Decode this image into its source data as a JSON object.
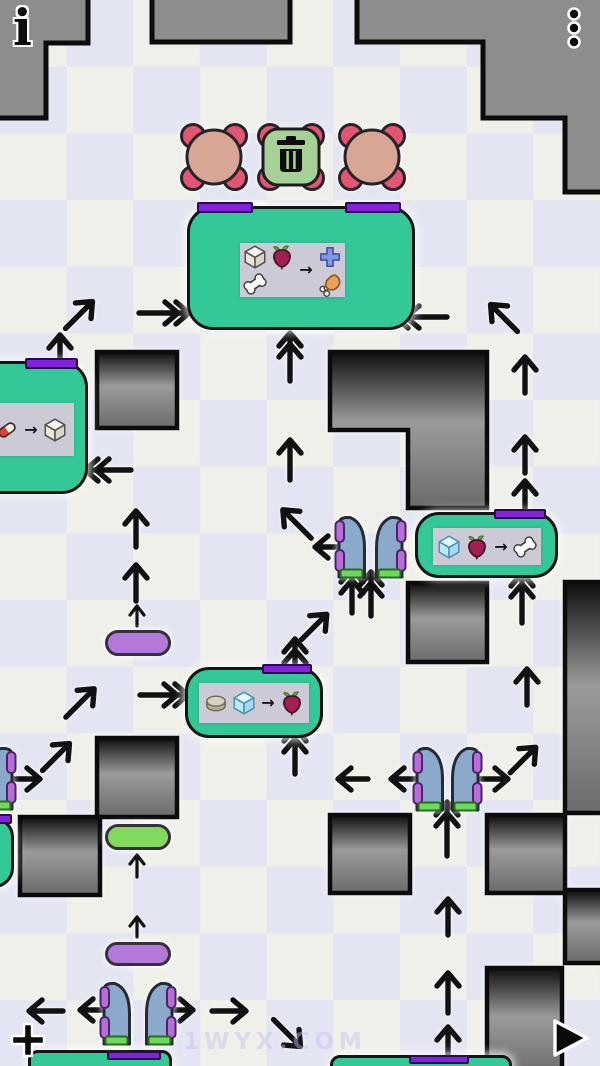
{
  "hud": {
    "info_glyph": "i",
    "watermark": "1WYX.COM"
  },
  "recipe_arrow": "→",
  "palette": {
    "checker_light": "#eff0e9",
    "checker_lavender": "#e3e5f2",
    "border_wall": "#8d8d8d",
    "machine_teal": "#34c797",
    "slot_purple": "#8520df",
    "foot_green": "#6cd95b",
    "gate_blue": "#8aa9cb",
    "gate_tab_purple": "#b46fd8",
    "spawner_pink": "#e45571",
    "spawner_tan": "#d7a695",
    "trash_green": "#a5d096",
    "pill_purple": "#b477da",
    "pill_green": "#82d95e"
  },
  "border_walls": [
    "M-10,-10 H88 V43 H46 V118 H-10 Z",
    "M152,-10 H290 V42 H152 Z",
    "M357,-10 H610 V192 H565 V118 H483 V42 H357 Z"
  ],
  "wall_blocks": [
    "M97,352 h80 v76 h-80 Z",
    "M330,352 H487 V508 H408 V430 H330 Z",
    "M408,583 h79 v79 h-79 Z",
    "M565,582 h50 v231 h-50 Z",
    "M330,815 h80 v78 h-80 Z",
    "M487,815 h78 v78 h-78 Z",
    "M565,890 h50 v73 h-50 Z",
    "M97,738 h80 v79 h-80 Z",
    "M20,817 h80 v78 h-80 Z",
    "M487,968 h75 v108 h-75 Z"
  ],
  "spawners": [
    {
      "x": 180,
      "y": 123,
      "kind": "creature"
    },
    {
      "x": 257,
      "y": 123,
      "kind": "trash"
    },
    {
      "x": 338,
      "y": 123,
      "kind": "creature"
    }
  ],
  "machines": [
    {
      "x": 187,
      "y": 206,
      "w": 228,
      "h": 124,
      "r": 26,
      "bars": [
        [
          197,
          202,
          56,
          11
        ],
        [
          345,
          202,
          56,
          11
        ]
      ],
      "panel": {
        "x": 240,
        "y": 243,
        "w": 105,
        "h": 54,
        "layout": "grid2"
      },
      "inputs": [
        "cube",
        "beet",
        "bone"
      ],
      "outputs": [
        "plus",
        "drumstick"
      ]
    },
    {
      "x": -52,
      "y": 361,
      "w": 140,
      "h": 133,
      "r": 26,
      "bars": [
        [
          25,
          358,
          53,
          11
        ]
      ],
      "panel": {
        "x": -12,
        "y": 403,
        "w": 86,
        "h": 53,
        "layout": "row"
      },
      "inputs": [
        "pill"
      ],
      "outputs": [
        "cube"
      ]
    },
    {
      "x": 415,
      "y": 512,
      "w": 143,
      "h": 66,
      "r": 24,
      "bars": [
        [
          494,
          509,
          52,
          10
        ]
      ],
      "panel": {
        "x": 433,
        "y": 528,
        "w": 108,
        "h": 37,
        "layout": "row"
      },
      "inputs": [
        "ice",
        "beet"
      ],
      "outputs": [
        "bone"
      ]
    },
    {
      "x": 185,
      "y": 667,
      "w": 138,
      "h": 71,
      "r": 24,
      "bars": [
        [
          262,
          664,
          50,
          10
        ]
      ],
      "panel": {
        "x": 199,
        "y": 683,
        "w": 110,
        "h": 40,
        "layout": "row"
      },
      "inputs": [
        "disc",
        "ice"
      ],
      "outputs": [
        "beet"
      ]
    },
    {
      "x": 28,
      "y": 1050,
      "w": 144,
      "h": 26,
      "r": 10,
      "bars": [
        [
          107,
          1051,
          54,
          9
        ]
      ]
    },
    {
      "x": 330,
      "y": 1055,
      "w": 182,
      "h": 22,
      "r": 10,
      "bars": [
        [
          409,
          1055,
          60,
          9
        ]
      ]
    },
    {
      "x": -60,
      "y": 817,
      "w": 74,
      "h": 71,
      "r": 20,
      "bars": [
        [
          -20,
          814,
          32,
          10
        ]
      ]
    }
  ],
  "gates": [
    {
      "y": 514,
      "h": 66,
      "doors": [
        {
          "x": 335,
          "flip": 0
        },
        {
          "x": 372,
          "flip": 1
        }
      ]
    },
    {
      "y": 745,
      "h": 68,
      "doors": [
        {
          "x": 413,
          "flip": 0
        },
        {
          "x": 448,
          "flip": 1
        }
      ]
    },
    {
      "y": 980,
      "h": 67,
      "doors": [
        {
          "x": 100,
          "flip": 0
        },
        {
          "x": 142,
          "flip": 1
        }
      ]
    },
    {
      "y": 745,
      "h": 67,
      "doors": [
        {
          "x": -18,
          "flip": 1
        }
      ]
    }
  ],
  "pills": [
    {
      "x": 105,
      "y": 630,
      "w": 66,
      "h": 26,
      "color": "#b477da"
    },
    {
      "x": 105,
      "y": 824,
      "w": 66,
      "h": 26,
      "color": "#82d95e"
    },
    {
      "x": 105,
      "y": 942,
      "w": 66,
      "h": 24,
      "color": "#b477da"
    }
  ],
  "arrows": [
    {
      "cx": 79,
      "cy": 315,
      "len": 38,
      "angle": 45,
      "kind": "s"
    },
    {
      "cx": 164,
      "cy": 313,
      "len": 50,
      "angle": 90,
      "kind": "d"
    },
    {
      "cx": 60,
      "cy": 353,
      "len": 36,
      "angle": 0,
      "kind": "s"
    },
    {
      "cx": 290,
      "cy": 357,
      "len": 48,
      "angle": 0,
      "kind": "d"
    },
    {
      "cx": 421,
      "cy": 317,
      "len": 52,
      "angle": 270,
      "kind": "d"
    },
    {
      "cx": 504,
      "cy": 318,
      "len": 38,
      "angle": 315,
      "kind": "s"
    },
    {
      "cx": 290,
      "cy": 460,
      "len": 40,
      "angle": 0,
      "kind": "s"
    },
    {
      "cx": 108,
      "cy": 470,
      "len": 46,
      "angle": 270,
      "kind": "d"
    },
    {
      "cx": 525,
      "cy": 375,
      "len": 36,
      "angle": 0,
      "kind": "s"
    },
    {
      "cx": 525,
      "cy": 455,
      "len": 36,
      "angle": 0,
      "kind": "s"
    },
    {
      "cx": 525,
      "cy": 497,
      "len": 32,
      "angle": 0,
      "kind": "s"
    },
    {
      "cx": 136,
      "cy": 529,
      "len": 36,
      "angle": 0,
      "kind": "s"
    },
    {
      "cx": 136,
      "cy": 583,
      "len": 36,
      "angle": 0,
      "kind": "s"
    },
    {
      "cx": 137,
      "cy": 616,
      "len": 20,
      "angle": 0,
      "kind": "m"
    },
    {
      "cx": 297,
      "cy": 524,
      "len": 40,
      "angle": 315,
      "kind": "s"
    },
    {
      "cx": 328,
      "cy": 547,
      "len": 26,
      "angle": 270,
      "kind": "s"
    },
    {
      "cx": 352,
      "cy": 591,
      "len": 44,
      "angle": 0,
      "kind": "d"
    },
    {
      "cx": 371,
      "cy": 594,
      "len": 44,
      "angle": 0,
      "kind": "d"
    },
    {
      "cx": 314,
      "cy": 627,
      "len": 36,
      "angle": 45,
      "kind": "s"
    },
    {
      "cx": 295,
      "cy": 657,
      "len": 36,
      "angle": 0,
      "kind": "d"
    },
    {
      "cx": 164,
      "cy": 695,
      "len": 48,
      "angle": 90,
      "kind": "d"
    },
    {
      "cx": 80,
      "cy": 703,
      "len": 40,
      "angle": 45,
      "kind": "s"
    },
    {
      "cx": 295,
      "cy": 751,
      "len": 46,
      "angle": 0,
      "kind": "d"
    },
    {
      "cx": 522,
      "cy": 598,
      "len": 50,
      "angle": 0,
      "kind": "d"
    },
    {
      "cx": 527,
      "cy": 687,
      "len": 36,
      "angle": 0,
      "kind": "s"
    },
    {
      "cx": 27,
      "cy": 779,
      "len": 26,
      "angle": 90,
      "kind": "s"
    },
    {
      "cx": 56,
      "cy": 757,
      "len": 38,
      "angle": 45,
      "kind": "s"
    },
    {
      "cx": 137,
      "cy": 866,
      "len": 22,
      "angle": 0,
      "kind": "m"
    },
    {
      "cx": 137,
      "cy": 927,
      "len": 20,
      "angle": 0,
      "kind": "m"
    },
    {
      "cx": 46,
      "cy": 1011,
      "len": 34,
      "angle": 270,
      "kind": "s"
    },
    {
      "cx": 93,
      "cy": 1010,
      "len": 26,
      "angle": 270,
      "kind": "s"
    },
    {
      "cx": 180,
      "cy": 1010,
      "len": 26,
      "angle": 90,
      "kind": "s"
    },
    {
      "cx": 229,
      "cy": 1011,
      "len": 34,
      "angle": 90,
      "kind": "s"
    },
    {
      "cx": 287,
      "cy": 1033,
      "len": 38,
      "angle": 135,
      "kind": "s"
    },
    {
      "cx": 448,
      "cy": 917,
      "len": 36,
      "angle": 0,
      "kind": "s"
    },
    {
      "cx": 448,
      "cy": 993,
      "len": 40,
      "angle": 0,
      "kind": "s"
    },
    {
      "cx": 448,
      "cy": 1047,
      "len": 40,
      "angle": 0,
      "kind": "s"
    },
    {
      "cx": 353,
      "cy": 779,
      "len": 30,
      "angle": 270,
      "kind": "s"
    },
    {
      "cx": 405,
      "cy": 779,
      "len": 28,
      "angle": 270,
      "kind": "s"
    },
    {
      "cx": 494,
      "cy": 779,
      "len": 28,
      "angle": 90,
      "kind": "s"
    },
    {
      "cx": 523,
      "cy": 760,
      "len": 36,
      "angle": 45,
      "kind": "s"
    },
    {
      "cx": 447,
      "cy": 829,
      "len": 54,
      "angle": 0,
      "kind": "d"
    }
  ]
}
